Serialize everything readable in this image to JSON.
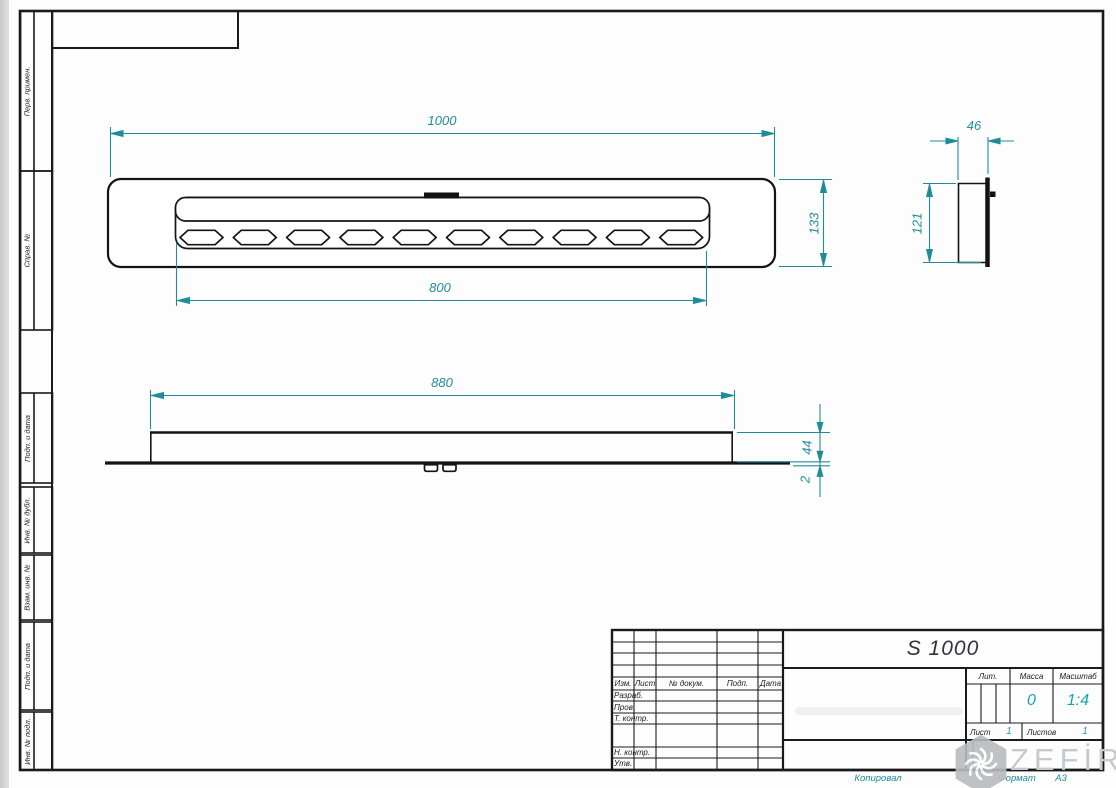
{
  "colors": {
    "dimension": "#1f8c99",
    "line": "#1a1a1a",
    "value_teal": "#179fae",
    "watermark_gray": "#c7cacc"
  },
  "margin_labels": [
    "Перв. примен.",
    "Справ. №",
    "Подп. и дата",
    "Инв. № дубл.",
    "Взам. инв. №",
    "Подп. и дата",
    "Инв. № подл."
  ],
  "dimensions": {
    "overall_length": "1000",
    "overall_height": "133",
    "slot_length": "800",
    "body_length": "880",
    "body_height": "44",
    "plate_thickness": "2",
    "side_depth": "46",
    "side_height": "121"
  },
  "title_block": {
    "designation": "S 1000",
    "change_header": [
      "Изм.",
      "Лист",
      "№ докум.",
      "Подп.",
      "Дата"
    ],
    "signature_rows": [
      "Разраб.",
      "Пров.",
      "Т. контр.",
      "Н. контр.",
      "Утв."
    ],
    "lit_label": "Лит.",
    "mass_label": "Масса",
    "mass_value": "0",
    "scale_label": "Масштаб",
    "scale_value": "1:4",
    "sheet_label": "Лист",
    "sheet_value": "1",
    "sheets_label": "Листов",
    "sheets_value": "1"
  },
  "footer": {
    "copied_label": "Копировал",
    "format_label": "Формат",
    "format_value": "А3"
  },
  "watermark": {
    "brand": "ZEFİRE"
  }
}
